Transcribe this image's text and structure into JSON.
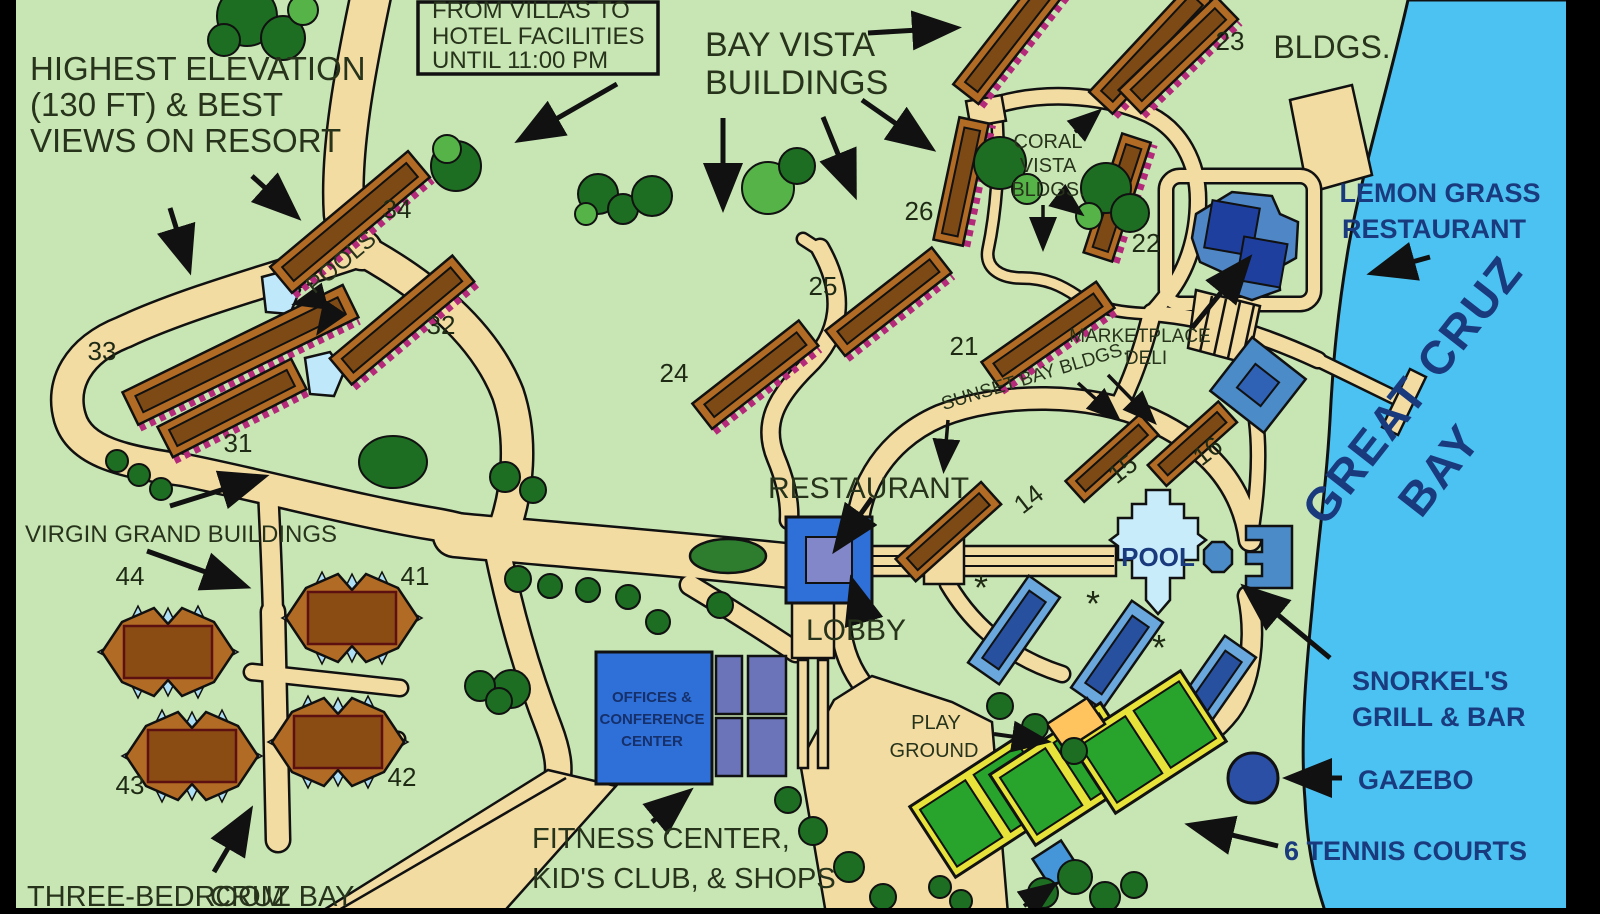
{
  "notice": {
    "l1": "FROM VILLAS TO",
    "l2": "HOTEL FACILITIES",
    "l3": "UNTIL 11:00 PM"
  },
  "labels": {
    "highest1": "HIGHEST ELEVATION",
    "highest2": "(130 FT) & BEST",
    "highest3": "VIEWS ON RESORT",
    "bayvista1": "BAY VISTA",
    "bayvista2": "BUILDINGS",
    "bldgs_top": "BLDGS.",
    "coral1": "CORAL",
    "coral2": "VISTA",
    "coral3": "BLDGS.",
    "lemon1": "LEMON GRASS",
    "lemon2": "RESTAURANT",
    "marketplace1": "MARKETPLACE",
    "marketplace2": "DELI",
    "sunset": "SUNSET BAY BLDGS.",
    "restaurant": "RESTAURANT",
    "lobby": "LOBBY",
    "pool": "POOL",
    "pools": "POOLS",
    "virgin": "VIRGIN GRAND BUILDINGS",
    "offices1": "OFFICES &",
    "offices2": "CONFERENCE",
    "offices3": "CENTER",
    "fitness1": "FITNESS CENTER,",
    "fitness2": "KID'S CLUB, & SHOPS",
    "play1": "PLAY",
    "play2": "GROUND",
    "snorkel1": "SNORKEL'S",
    "snorkel2": "GRILL & BAR",
    "gazebo": "GAZEBO",
    "tennis": "6 TENNIS COURTS",
    "bay1": "GREAT CRUZ",
    "bay2": "BAY",
    "threebed": "THREE-BEDROOM",
    "cruzbay": "CRUZ BAY",
    "asterisk": "*"
  },
  "numbers": {
    "34": "34",
    "33": "33",
    "32": "32",
    "31": "31",
    "26": "26",
    "25": "25",
    "24": "24",
    "23": "23",
    "22": "22",
    "21": "21",
    "16": "16",
    "15": "15",
    "14": "14",
    "44": "44",
    "41": "41",
    "43": "43",
    "42": "42"
  },
  "colors": {
    "land": "#c8e6b4",
    "water": "#4cc2f2",
    "road": "#f2dca2",
    "building_brown": "#b26b24",
    "balcony_pink": "#b5297a",
    "pool_blue": "#c9ecfa",
    "facility_blue": "#2f6fd8",
    "hotel_blue": "#6aa7dc",
    "tennis_green": "#28a42c",
    "tennis_trim": "#e8e33a",
    "gazebo_blue": "#2b4fa5",
    "playground_orange": "#ffc45e",
    "text_dark": "#27331b",
    "text_navy": "#1a3a7e"
  }
}
